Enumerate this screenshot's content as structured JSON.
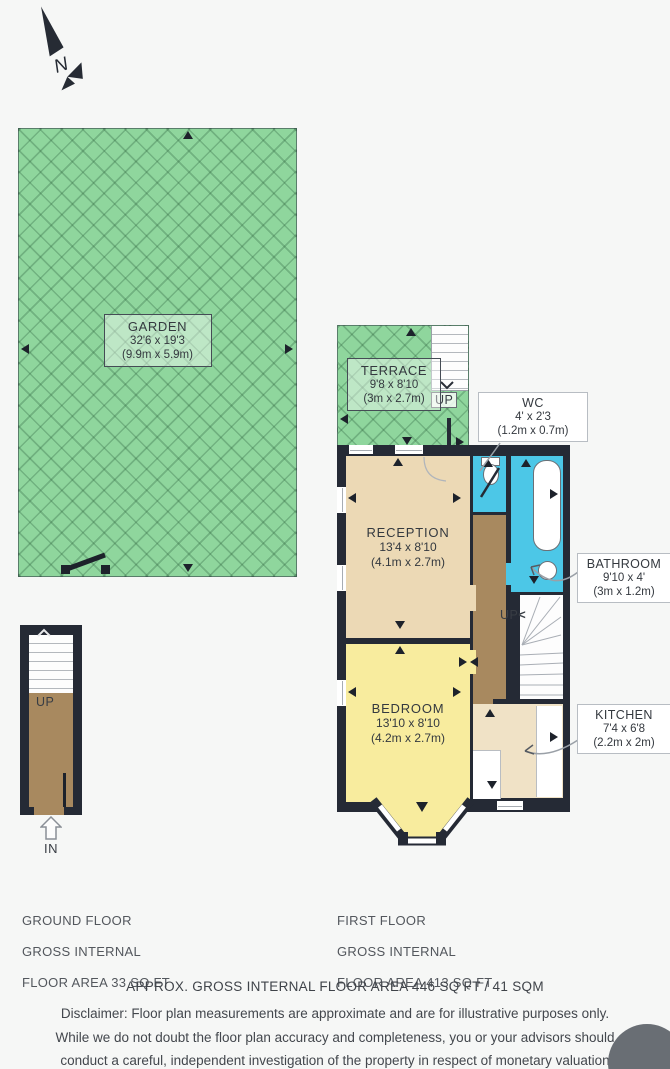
{
  "compass": {
    "label": "N"
  },
  "garden": {
    "name": "GARDEN",
    "dims_ft": "32'6 x 19'3",
    "dims_m": "(9.9m x 5.9m)"
  },
  "terrace": {
    "name": "TERRACE",
    "dims_ft": "9'8 x 8'10",
    "dims_m": "(3m x 2.7m)",
    "up_label": "UP"
  },
  "rooms": {
    "wc": {
      "name": "WC",
      "dims_ft": "4' x 2'3",
      "dims_m": "(1.2m x 0.7m)"
    },
    "reception": {
      "name": "RECEPTION",
      "dims_ft": "13'4 x 8'10",
      "dims_m": "(4.1m x 2.7m)"
    },
    "bathroom": {
      "name": "BATHROOM",
      "dims_ft": "9'10 x 4'",
      "dims_m": "(3m x 1.2m)"
    },
    "bedroom": {
      "name": "BEDROOM",
      "dims_ft": "13'10 x 8'10",
      "dims_m": "(4.2m x 2.7m)"
    },
    "kitchen": {
      "name": "KITCHEN",
      "dims_ft": "7'4 x 6'8",
      "dims_m": "(2.2m x 2m)"
    },
    "hall_up_label": "UP"
  },
  "ground_plan": {
    "up_label": "UP",
    "in_label": "IN"
  },
  "footer": {
    "ground": [
      "GROUND FLOOR",
      "GROSS INTERNAL",
      "FLOOR AREA 33 SQ FT"
    ],
    "first": [
      "FIRST FLOOR",
      "GROSS INTERNAL",
      "FLOOR AREA 413 SQ FT"
    ],
    "approx": "APPROX. GROSS INTERNAL FLOOR AREA 446 SQ FT / 41 SQM",
    "disclaimer": [
      "Disclaimer: Floor plan measurements are approximate and are for illustrative purposes only.",
      "While we do not doubt the floor plan accuracy and completeness, you or your advisors should",
      "conduct a careful, independent investigation of the property in respect of monetary valuation"
    ]
  },
  "colors": {
    "walls": "#252a35",
    "garden_green": "#8fd69d",
    "bath_blue": "#4cc7e7",
    "hall_brown": "#a8895f",
    "reception_beige": "#ecd9b5",
    "kitchen_beige": "#f0e2c6",
    "bedroom_yellow": "#f8ec9e",
    "badge_gray": "#696e74"
  }
}
